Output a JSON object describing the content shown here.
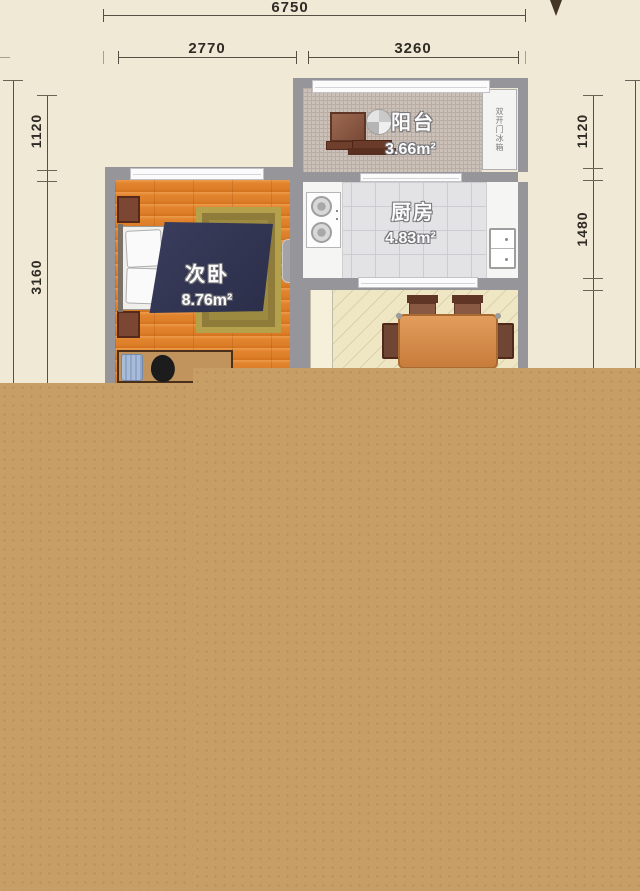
{
  "plan": {
    "title": "apartment floor plan",
    "dimensions": {
      "top_total": "6750",
      "top_left": "2770",
      "top_right": "3260",
      "left_upper": "1120",
      "left_lower": "3160",
      "right_upper": "1120",
      "right_middle": "1480"
    },
    "rooms": {
      "balcony": {
        "name": "阳台",
        "area": "3.66m²"
      },
      "kitchen": {
        "name": "厨房",
        "area": "4.83m²"
      },
      "bedroom": {
        "name": "次卧",
        "area": "8.76m²"
      }
    },
    "labels": {
      "fridge": "双开门冰箱"
    },
    "colors": {
      "background": "#f0e9d6",
      "cover": "#c69e66",
      "wall": "#95959a",
      "bedroom_floor": "#dd7d27",
      "dining_floor": "#efe6c4",
      "kitchen_floor": "#e3e3e5",
      "balcony_floor": "#ccc1b8",
      "blanket": "#32344f"
    }
  }
}
